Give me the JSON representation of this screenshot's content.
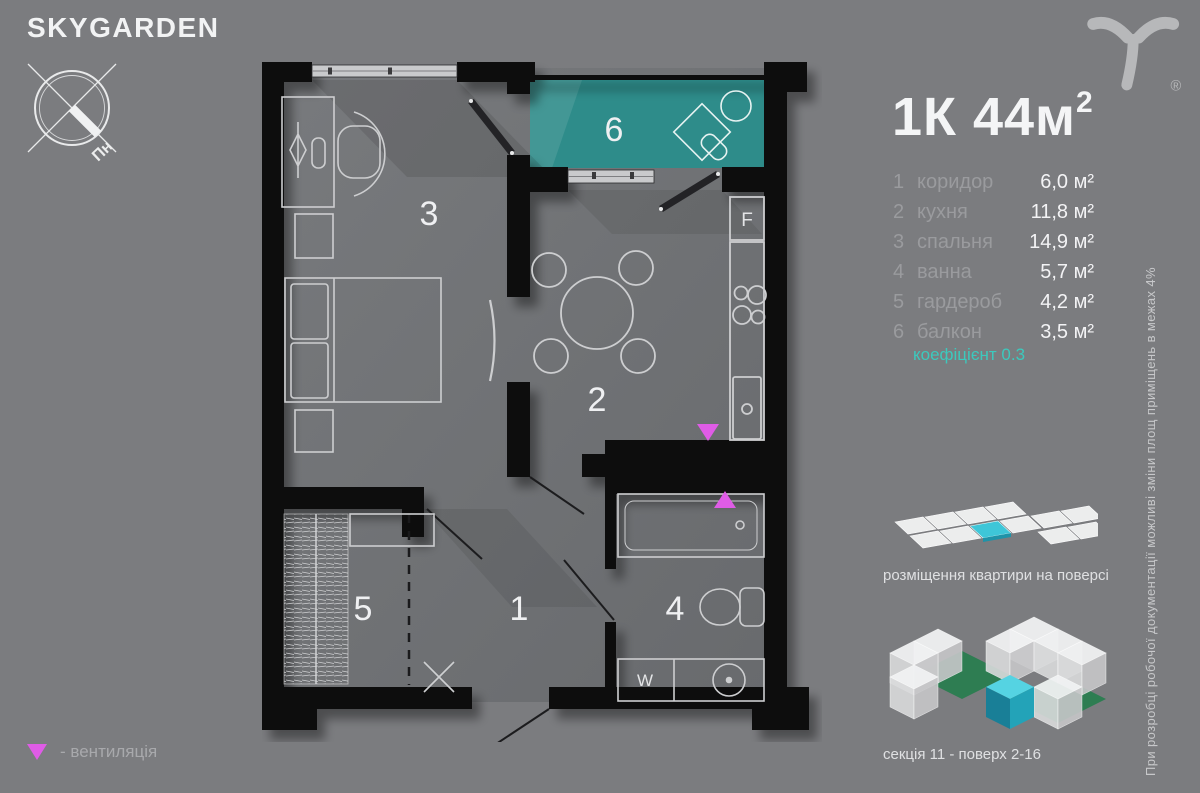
{
  "brand": {
    "name": "SKYGARDEN",
    "registered": "®"
  },
  "compass": {
    "north_label": "Пн"
  },
  "apartment": {
    "title": "1К 44м",
    "title_sup": "2"
  },
  "rooms": [
    {
      "num": "1",
      "name": "коридор",
      "area": "6,0 м²"
    },
    {
      "num": "2",
      "name": "кухня",
      "area": "11,8 м²"
    },
    {
      "num": "3",
      "name": "спальня",
      "area": "14,9 м²"
    },
    {
      "num": "4",
      "name": "ванна",
      "area": "5,7 м²"
    },
    {
      "num": "5",
      "name": "гардероб",
      "area": "4,2 м²"
    },
    {
      "num": "6",
      "name": "балкон",
      "area": "3,5 м²"
    }
  ],
  "coefficient_note": "коефіцієнт 0.3",
  "plan": {
    "room_numbers": {
      "corridor": "1",
      "kitchen": "2",
      "bedroom": "3",
      "bathroom": "4",
      "wardrobe": "5",
      "balcony": "6"
    },
    "fridge_label": "F",
    "washer_label": "W"
  },
  "floor_diagram": {
    "caption": "розміщення квартири на поверсі"
  },
  "building_view": {
    "caption": "секція 11 - поверх 2-16"
  },
  "legend": {
    "ventilation": "- вентиляція"
  },
  "disclaimer": "При розробці робочої документації можливі зміни площ приміщень в межах 4%",
  "colors": {
    "background": "#7b7c7f",
    "walls": "#0b0b0c",
    "balcony_teal": "#2e8c8a",
    "ventilation_magenta": "#df5ce6",
    "coefficient_teal": "#3cc9bd",
    "highlight_cyan": "#3ec6d8",
    "courtyard_green": "#2e7d52"
  }
}
